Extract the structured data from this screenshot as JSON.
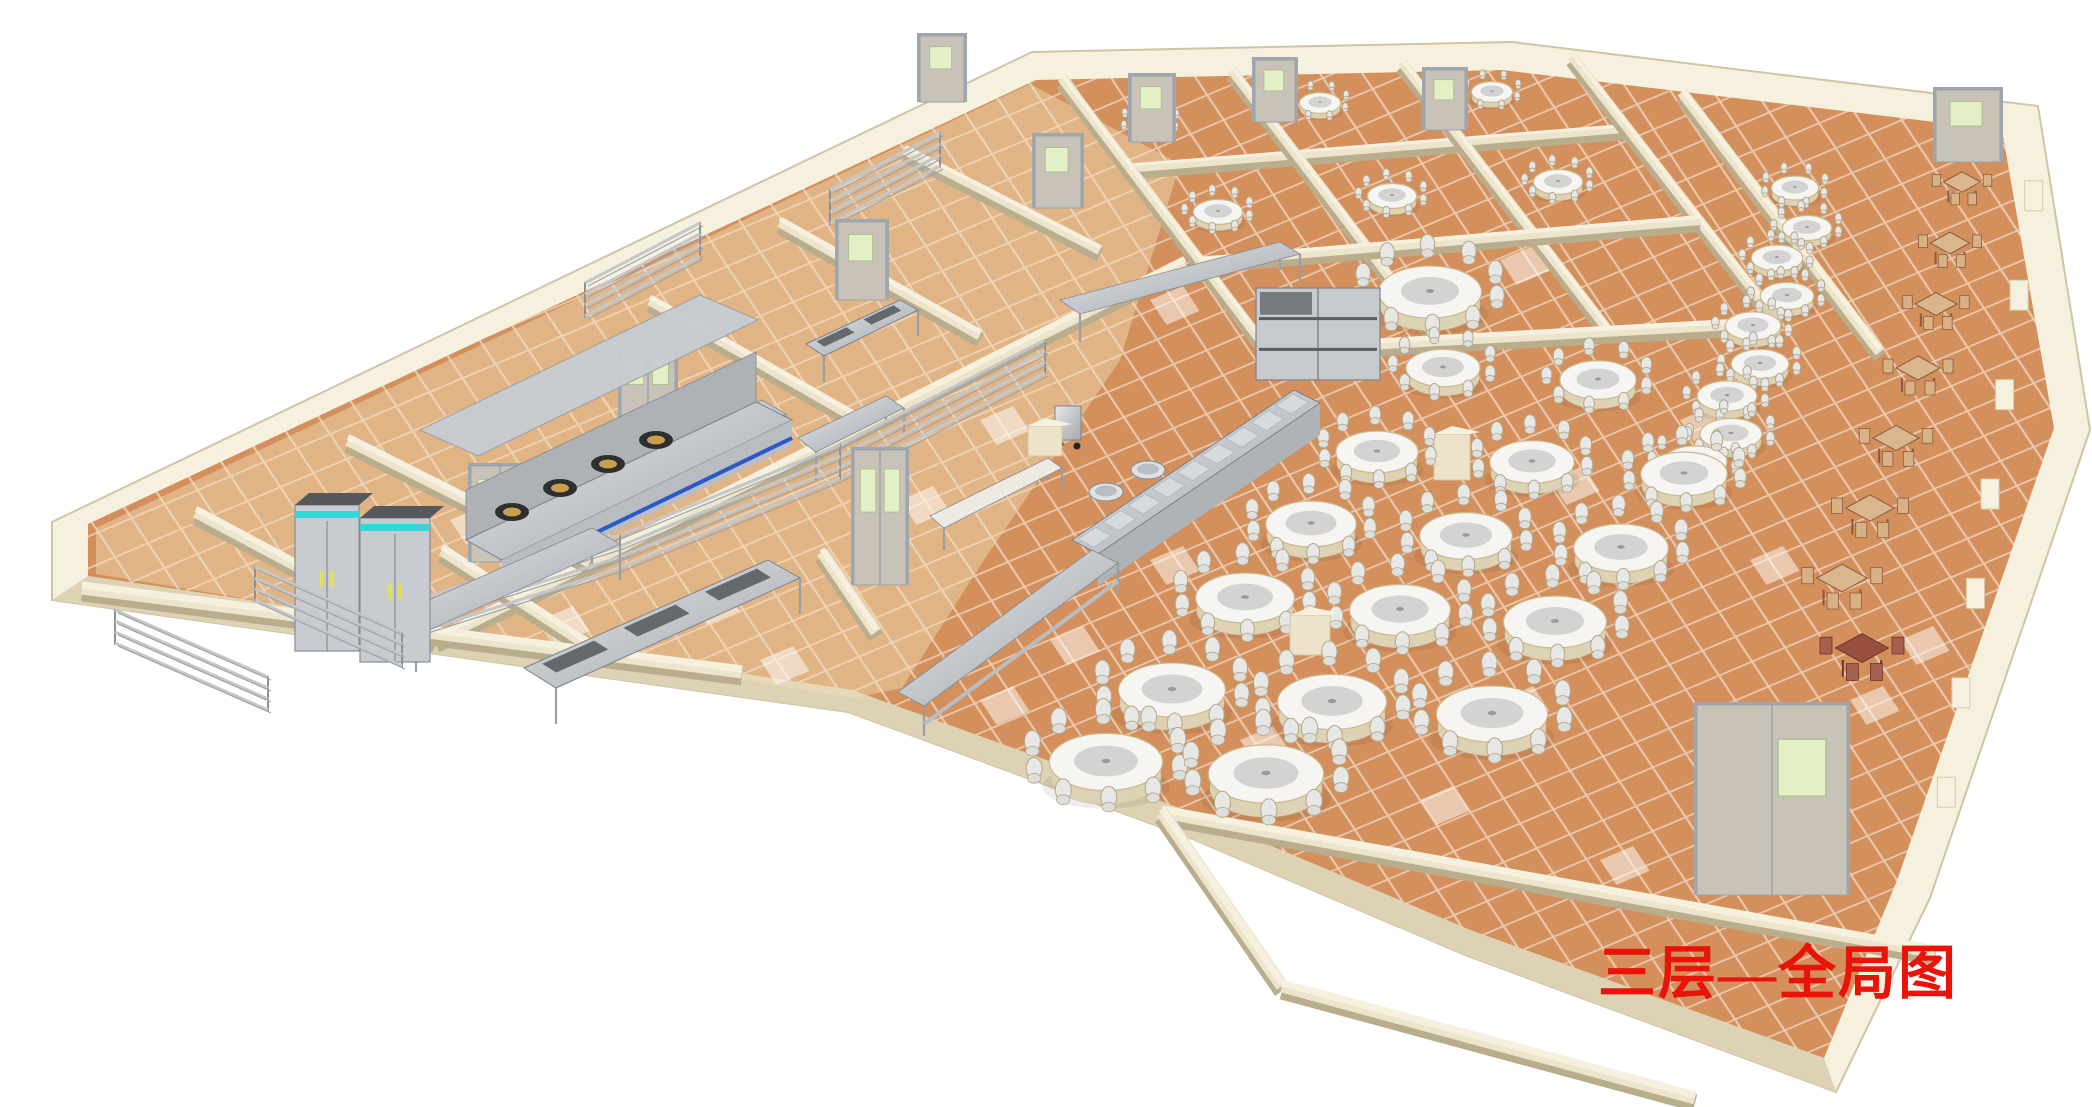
{
  "caption": {
    "text": "三层—全局图",
    "color": "#e8140a"
  },
  "palette": {
    "background": "#ffffff",
    "tile_orange": "#d4905c",
    "tile_grout": "rgba(255,255,255,0.5)",
    "tile_highlight": "#fdf0da",
    "kitchen_tint": "rgba(242,224,186,0.45)",
    "wall_face": "#ece4cb",
    "wall_top": "#f6f1de",
    "wall_shadow": "#b9ad8d",
    "wall_front": "#ddd3b4",
    "metal_light": "#e8eaec",
    "metal_mid": "#bfc3c8",
    "metal_dark": "#8d9196",
    "fridge_accent": "#35d8d8",
    "fridge_handle": "#dde05a",
    "range_stripe": "#2b57c8",
    "burner_ring": "#2f2f33",
    "burner_center": "#c9a050",
    "door_frame": "#a0a6ad",
    "door_leaf": "#c9c2b9",
    "door_window": "#e3efc4",
    "table_top": "#f6f5f2",
    "table_skirt": "#ddd2b3",
    "lazy_susan": "#d2d3d2",
    "chair_fill": "#e7e7e5",
    "chair_frame": "#b3a78a",
    "wood_top": "#d9b68b",
    "wood_leg": "#8a5a40",
    "wood_dark": "#9a4f3e"
  },
  "scene": {
    "outline": [
      [
        52,
        522
      ],
      [
        1032,
        52
      ],
      [
        1512,
        42
      ],
      [
        2038,
        106
      ],
      [
        2090,
        430
      ],
      [
        1930,
        898
      ],
      [
        1836,
        1092
      ],
      [
        1465,
        955
      ],
      [
        1190,
        838
      ],
      [
        848,
        712
      ],
      [
        52,
        600
      ]
    ],
    "floor": [
      [
        88,
        524
      ],
      [
        1036,
        80
      ],
      [
        1502,
        70
      ],
      [
        2002,
        130
      ],
      [
        2054,
        428
      ],
      [
        1898,
        878
      ],
      [
        1824,
        1058
      ],
      [
        1470,
        930
      ],
      [
        1196,
        814
      ],
      [
        852,
        690
      ],
      [
        88,
        576
      ]
    ],
    "front_face": [
      [
        88,
        576
      ],
      [
        852,
        690
      ],
      [
        1196,
        814
      ],
      [
        1470,
        930
      ],
      [
        1824,
        1058
      ],
      [
        1836,
        1092
      ],
      [
        1465,
        955
      ],
      [
        1190,
        838
      ],
      [
        848,
        712
      ],
      [
        52,
        600
      ]
    ],
    "kitchen_tint_poly": [
      [
        96,
        528
      ],
      [
        1030,
        84
      ],
      [
        1180,
        164
      ],
      [
        1120,
        360
      ],
      [
        980,
        566
      ],
      [
        902,
        688
      ],
      [
        854,
        698
      ],
      [
        96,
        574
      ]
    ],
    "tile_matrix": [
      33.1,
      -14,
      16.5,
      24.9
    ],
    "highlight_tiles": [
      [
        350,
        560
      ],
      [
        540,
        620
      ],
      [
        760,
        660
      ],
      [
        980,
        700
      ],
      [
        690,
        600
      ],
      [
        450,
        520
      ],
      [
        1240,
        740
      ],
      [
        1420,
        800
      ],
      [
        1600,
        860
      ],
      [
        1050,
        640
      ],
      [
        1500,
        700
      ],
      [
        1700,
        760
      ],
      [
        900,
        500
      ],
      [
        1150,
        560
      ],
      [
        1350,
        620
      ],
      [
        1850,
        700
      ],
      [
        1150,
        300
      ],
      [
        1300,
        350
      ],
      [
        1500,
        260
      ],
      [
        980,
        420
      ],
      [
        1750,
        560
      ],
      [
        1900,
        640
      ],
      [
        1550,
        480
      ],
      [
        1680,
        420
      ]
    ],
    "walls": [
      [
        196,
        512,
        436,
        640,
        12
      ],
      [
        348,
        440,
        590,
        562,
        12
      ],
      [
        650,
        300,
        860,
        420,
        11
      ],
      [
        780,
        222,
        980,
        335,
        11
      ],
      [
        905,
        150,
        1100,
        250,
        10
      ],
      [
        436,
        640,
        1185,
        262,
        12
      ],
      [
        82,
        588,
        742,
        672,
        13
      ],
      [
        442,
        550,
        596,
        650,
        12
      ],
      [
        822,
        552,
        876,
        632,
        12
      ],
      [
        1062,
        78,
        1268,
        350,
        10
      ],
      [
        1232,
        70,
        1438,
        340,
        10
      ],
      [
        1402,
        62,
        1608,
        330,
        10
      ],
      [
        1572,
        56,
        1778,
        322,
        10
      ],
      [
        1130,
        168,
        1630,
        128,
        9
      ],
      [
        1198,
        262,
        1700,
        220,
        10
      ],
      [
        1268,
        350,
        1778,
        322,
        11
      ],
      [
        1682,
        92,
        1880,
        352,
        11
      ],
      [
        1162,
        812,
        1935,
        952,
        13
      ],
      [
        1162,
        812,
        1282,
        986,
        13
      ],
      [
        1282,
        986,
        1695,
        1098,
        13
      ]
    ],
    "pilaster_line": {
      "a": [
        2042,
        150
      ],
      "b": [
        1938,
        860
      ],
      "t": [
        0.08,
        0.22,
        0.36,
        0.5,
        0.64,
        0.78,
        0.92
      ]
    },
    "round_tables": [
      [
        1150,
        122,
        20
      ],
      [
        1320,
        103,
        20
      ],
      [
        1492,
        92,
        20
      ],
      [
        1218,
        212,
        24
      ],
      [
        1392,
        196,
        24
      ],
      [
        1558,
        182,
        24
      ],
      [
        1430,
        292,
        50
      ],
      [
        1795,
        188,
        23
      ],
      [
        1807,
        228,
        24
      ],
      [
        1777,
        258,
        25
      ],
      [
        1787,
        296,
        26
      ],
      [
        1753,
        326,
        27
      ],
      [
        1760,
        364,
        28
      ],
      [
        1727,
        396,
        29
      ],
      [
        1731,
        434,
        30
      ],
      [
        1695,
        462,
        31
      ],
      [
        1443,
        368,
        36
      ],
      [
        1598,
        380,
        37
      ],
      [
        1377,
        452,
        40
      ],
      [
        1532,
        462,
        41
      ],
      [
        1684,
        474,
        42
      ],
      [
        1311,
        524,
        44
      ],
      [
        1466,
        536,
        45
      ],
      [
        1621,
        548,
        46
      ],
      [
        1245,
        598,
        48
      ],
      [
        1400,
        610,
        49
      ],
      [
        1555,
        622,
        50
      ],
      [
        1172,
        690,
        52
      ],
      [
        1332,
        702,
        53
      ],
      [
        1492,
        714,
        54
      ],
      [
        1106,
        762,
        55
      ],
      [
        1266,
        774,
        56
      ]
    ],
    "wood_tables": [
      [
        1962,
        182,
        0.85,
        0
      ],
      [
        1950,
        243,
        0.9,
        0
      ],
      [
        1936,
        304,
        0.95,
        0
      ],
      [
        1918,
        368,
        1.0,
        0
      ],
      [
        1896,
        438,
        1.05,
        0
      ],
      [
        1870,
        508,
        1.1,
        0
      ],
      [
        1842,
        578,
        1.15,
        0
      ],
      [
        1862,
        648,
        1.2,
        1
      ]
    ],
    "racks": [
      [
        115,
        645,
        268,
        712
      ],
      [
        255,
        602,
        402,
        668
      ],
      [
        585,
        318,
        700,
        258
      ],
      [
        830,
        225,
        940,
        168
      ],
      [
        400,
        640,
        620,
        570
      ],
      [
        620,
        570,
        840,
        480
      ],
      [
        840,
        480,
        1045,
        375
      ]
    ],
    "tables_quads": [
      {
        "q": [
          [
            388,
            618
          ],
          [
            592,
            528
          ],
          [
            620,
            544
          ],
          [
            416,
            636
          ]
        ],
        "leg": 36
      },
      {
        "q": [
          [
            798,
            438
          ],
          [
            886,
            396
          ],
          [
            904,
            408
          ],
          [
            816,
            452
          ]
        ],
        "leg": 28
      },
      {
        "q": [
          [
            618,
            468
          ],
          [
            762,
            400
          ],
          [
            786,
            414
          ],
          [
            642,
            484
          ]
        ],
        "leg": 32
      },
      {
        "q": [
          [
            1060,
            300
          ],
          [
            1280,
            242
          ],
          [
            1300,
            254
          ],
          [
            1080,
            314
          ]
        ],
        "leg": 28
      },
      {
        "q": [
          [
            930,
            516
          ],
          [
            1048,
            458
          ],
          [
            1062,
            468
          ],
          [
            944,
            528
          ]
        ],
        "leg": 22,
        "white": 1
      }
    ],
    "sinks": [
      {
        "q": [
          [
            524,
            668
          ],
          [
            768,
            560
          ],
          [
            800,
            578
          ],
          [
            556,
            688
          ]
        ],
        "leg": 36,
        "bowls": 3
      },
      {
        "q": [
          [
            806,
            344
          ],
          [
            900,
            300
          ],
          [
            918,
            310
          ],
          [
            824,
            356
          ]
        ],
        "leg": 26,
        "bowls": 2
      }
    ],
    "counter": {
      "q": [
        [
          898,
          692
        ],
        [
          1092,
          550
        ],
        [
          1118,
          563
        ],
        [
          924,
          706
        ]
      ],
      "face": 30
    },
    "trayline": {
      "q": [
        [
          1072,
          540
        ],
        [
          1294,
          390
        ],
        [
          1320,
          403
        ],
        [
          1098,
          554
        ]
      ],
      "face": 32,
      "pots": [
        [
          1106,
          492
        ],
        [
          1148,
          470
        ]
      ]
    },
    "cart": [
      1068,
      440
    ],
    "cabinet": [
      1256,
      288,
      124,
      92
    ],
    "pedestals": [
      [
        1310,
        655,
        40,
        40
      ],
      [
        1452,
        480,
        36,
        46
      ],
      [
        1045,
        456,
        34,
        30
      ]
    ],
    "fridges": [
      [
        295,
        505,
        64,
        146
      ],
      [
        360,
        518,
        70,
        144
      ]
    ],
    "cookline": {
      "base": [
        [
          466,
          540
        ],
        [
          756,
          402
        ],
        [
          792,
          420
        ],
        [
          502,
          560
        ]
      ],
      "back": [
        [
          466,
          540
        ],
        [
          756,
          402
        ],
        [
          756,
          352
        ],
        [
          466,
          490
        ]
      ],
      "hood": [
        [
          420,
          430
        ],
        [
          700,
          295
        ],
        [
          758,
          320
        ],
        [
          478,
          456
        ]
      ],
      "burners": [
        [
          512,
          512
        ],
        [
          560,
          488
        ],
        [
          608,
          464
        ],
        [
          656,
          440
        ]
      ]
    },
    "doors": [
      [
        942,
        102,
        44,
        66,
        1
      ],
      [
        1058,
        208,
        46,
        72,
        1
      ],
      [
        1152,
        142,
        42,
        66,
        1
      ],
      [
        1275,
        122,
        40,
        62,
        1
      ],
      [
        1445,
        130,
        40,
        60,
        1
      ],
      [
        1968,
        162,
        64,
        72,
        1
      ],
      [
        862,
        300,
        48,
        78,
        1
      ],
      [
        648,
        432,
        54,
        88,
        2
      ],
      [
        500,
        562,
        58,
        96,
        2
      ],
      [
        880,
        585,
        52,
        135,
        2
      ],
      [
        1772,
        895,
        150,
        190,
        3
      ]
    ]
  }
}
